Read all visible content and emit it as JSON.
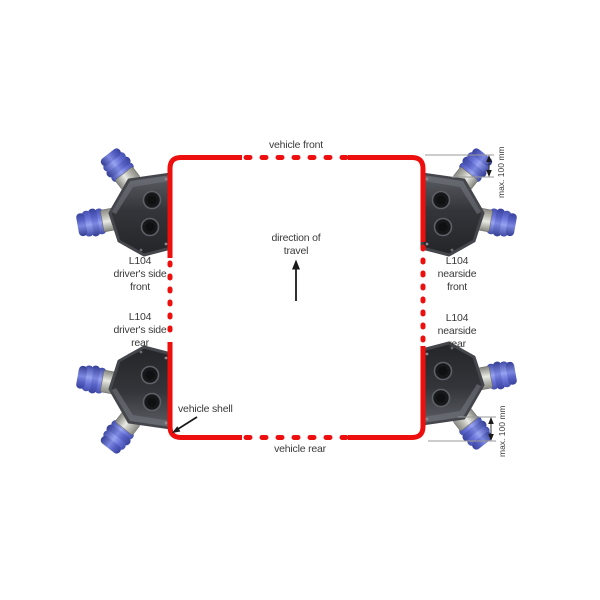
{
  "labels": {
    "vehicle_front": "vehicle front",
    "vehicle_rear": "vehicle rear",
    "vehicle_shell": "vehicle shell",
    "direction_of_travel": "direction of\ntravel"
  },
  "sensors": [
    {
      "id": "drivers-side-front",
      "label": "L104\ndriver's side\nfront"
    },
    {
      "id": "drivers-side-rear",
      "label": "L104\ndriver's side\nrear"
    },
    {
      "id": "nearside-front",
      "label": "L104\nnearside\nfront"
    },
    {
      "id": "nearside-rear",
      "label": "L104\nnearside\nrear"
    }
  ],
  "dimensions": {
    "top": "max. 100 mm",
    "bottom": "max. 100 mm"
  },
  "colors": {
    "shell_red": "#ed0e0e",
    "bellows_blue": "#6a74d8",
    "housing_gray": "#33353a",
    "dimension_line_gray": "#9a9a9a",
    "label_text": "#3a3a3a"
  }
}
